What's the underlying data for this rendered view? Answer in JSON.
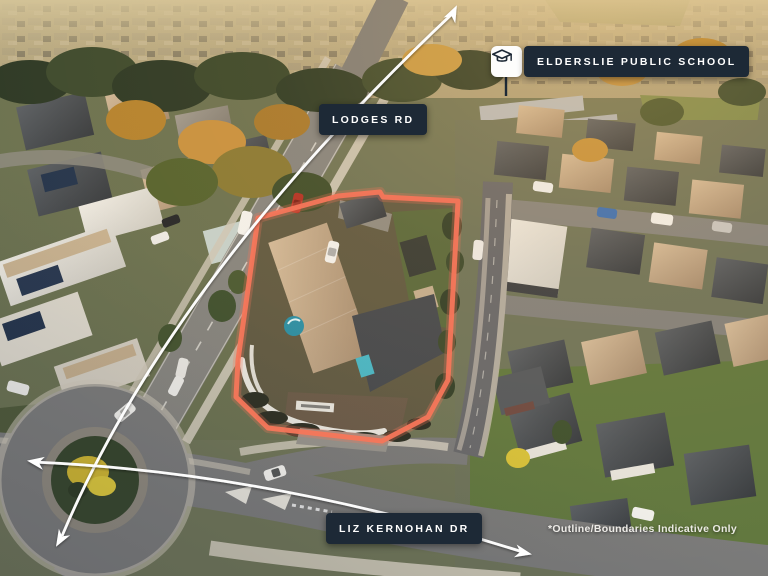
{
  "annotations": {
    "school_label": "ELDERSLIE PUBLIC SCHOOL",
    "road_label_top": "LODGES RD",
    "road_label_bottom": "LIZ KERNOHAN DR",
    "disclaimer": "*Outline/Boundaries Indicative Only"
  },
  "colors": {
    "label_background": "#1d2936",
    "label_text": "#ffffff",
    "property_outline": "#f5765a",
    "arrow": "#ffffff"
  }
}
